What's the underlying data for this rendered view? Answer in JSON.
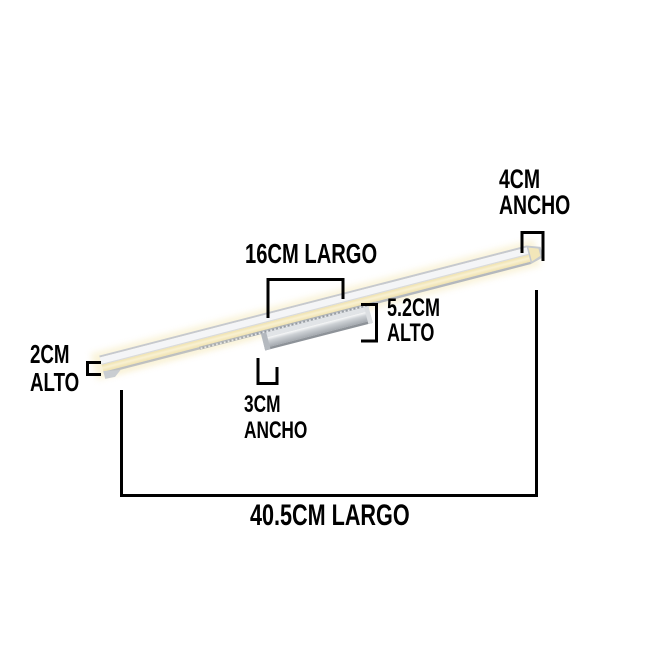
{
  "canvas": {
    "background": "#ffffff",
    "line_color": "#000000",
    "text_color": "#000000"
  },
  "product": {
    "name": "LED mirror wall light bar with center mount",
    "colors": {
      "glow": "#f3e6b8",
      "glow_bright": "#f9f1d3",
      "glow_halo": "#f7edc6",
      "body_white": "#f4f5f7",
      "top_edge": "#c6c9ce",
      "divider": "#d9dbde",
      "bottom_edge": "#b4b8bd",
      "mount_top": "#e1e4e7",
      "mount_dark": "#8e9399",
      "mount_end_left": "#b4b9bf",
      "mount_end_right": "#dcdfe2",
      "end_cap": "#c5c9cd",
      "end_cap_inner": "#f2e6b9",
      "tip_wedge": "#c9cdd1"
    }
  },
  "dimensions": {
    "end_width": {
      "value": "4CM",
      "unit_label": "ANCHO"
    },
    "mid_length": {
      "text": "16CM LARGO"
    },
    "total_height": {
      "value": "5.2CM",
      "unit_label": "ALTO"
    },
    "bar_height": {
      "value": "2CM",
      "unit_label": "ALTO"
    },
    "mount_width": {
      "value": "3CM",
      "unit_label": "ANCHO"
    },
    "total_length": {
      "text": "40.5CM LARGO"
    }
  }
}
